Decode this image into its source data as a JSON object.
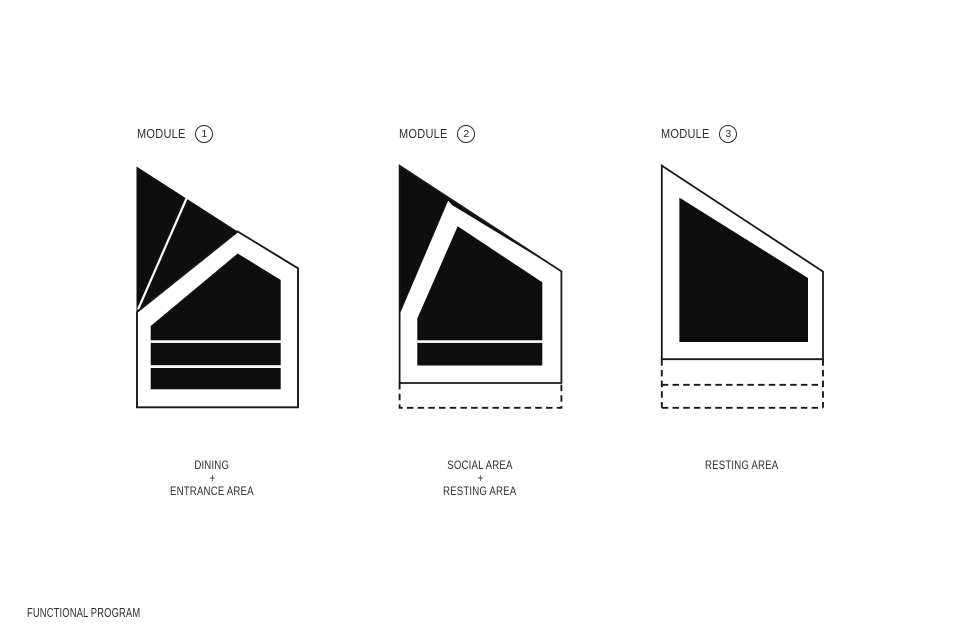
{
  "title": {
    "label": "FUNCTIONAL PROGRAM"
  },
  "colors": {
    "background": "#ffffff",
    "shape_fill": "#0e0e0e",
    "outline": "#191919",
    "text": "#2e2e2e"
  },
  "modules": [
    {
      "label": "MODULE",
      "number": "1",
      "areas": [
        "DINING",
        "+",
        "ENTRANCE AREA"
      ]
    },
    {
      "label": "MODULE",
      "number": "2",
      "areas": [
        "SOCIAL AREA",
        "+",
        "RESTING AREA"
      ]
    },
    {
      "label": "MODULE",
      "number": "3",
      "areas": [
        "RESTING AREA"
      ]
    }
  ]
}
